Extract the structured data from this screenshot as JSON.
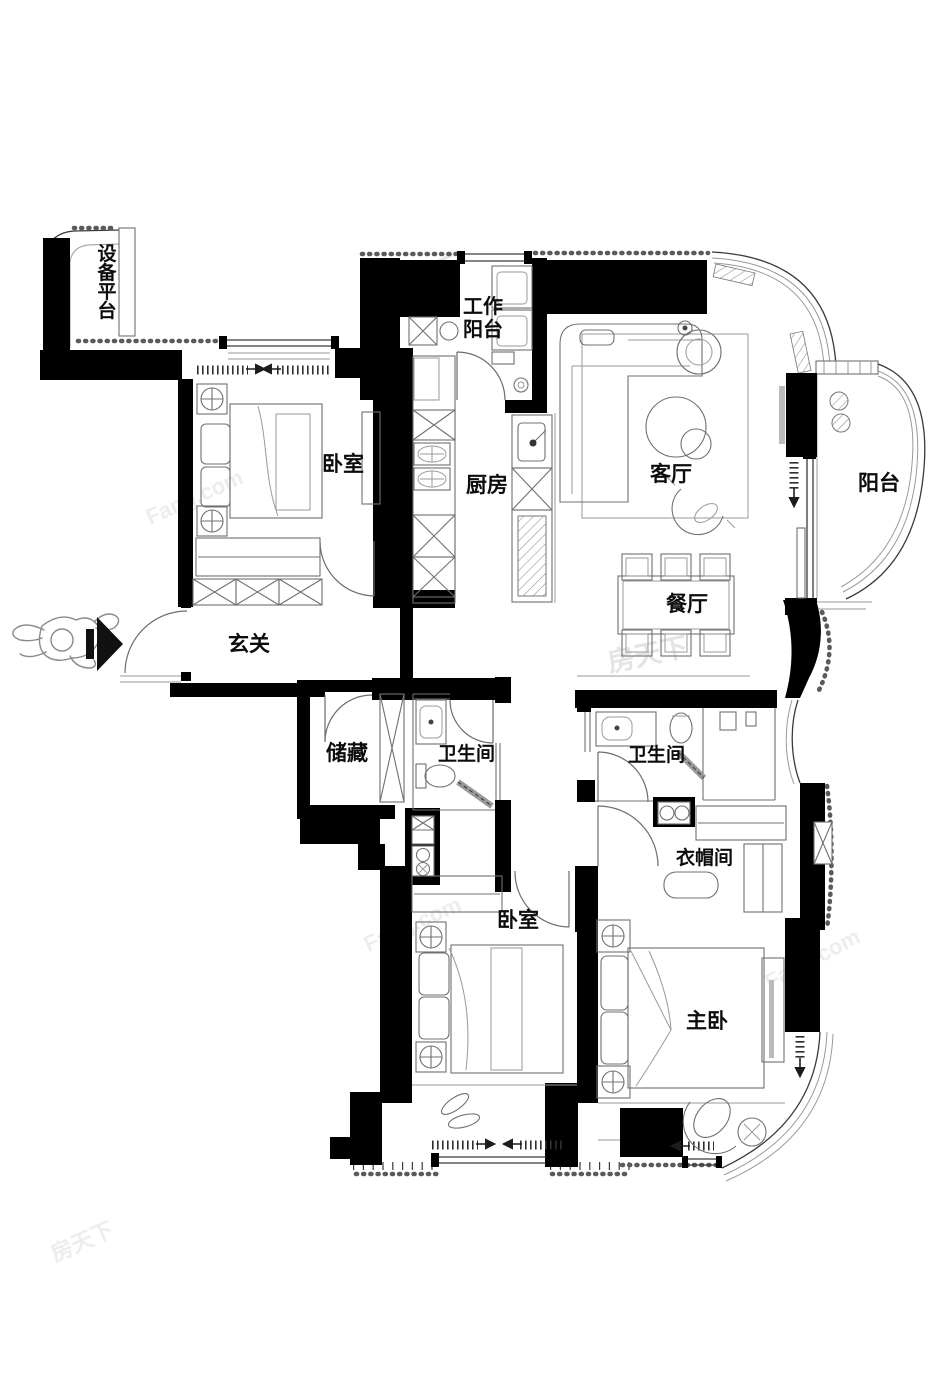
{
  "plan_type": "apartment-floor-plan",
  "rooms": {
    "equipment_platform": {
      "label": "设备平台",
      "chars": [
        "设",
        "备",
        "平",
        "台"
      ]
    },
    "work_balcony": {
      "label": "工作阳台",
      "line1": "工作",
      "line2": "阳台"
    },
    "bedroom_left": {
      "label": "卧室"
    },
    "kitchen": {
      "label": "厨房"
    },
    "living_room": {
      "label": "客厅"
    },
    "balcony": {
      "label": "阳台"
    },
    "dining_room": {
      "label": "餐厅"
    },
    "entry": {
      "label": "玄关"
    },
    "storage": {
      "label": "储藏"
    },
    "bathroom_left": {
      "label": "卫生间"
    },
    "bathroom_right": {
      "label": "卫生间"
    },
    "cloakroom": {
      "label": "衣帽间"
    },
    "bedroom_bottom": {
      "label": "卧室"
    },
    "master_bedroom": {
      "label": "主卧"
    }
  },
  "watermark": {
    "cn": "房天下",
    "en": "Fang.com"
  },
  "colors": {
    "wall": "#000000",
    "line": "#707070",
    "label": "#0c0c0c",
    "watermark": "#e4e4e4",
    "background": "#ffffff"
  }
}
